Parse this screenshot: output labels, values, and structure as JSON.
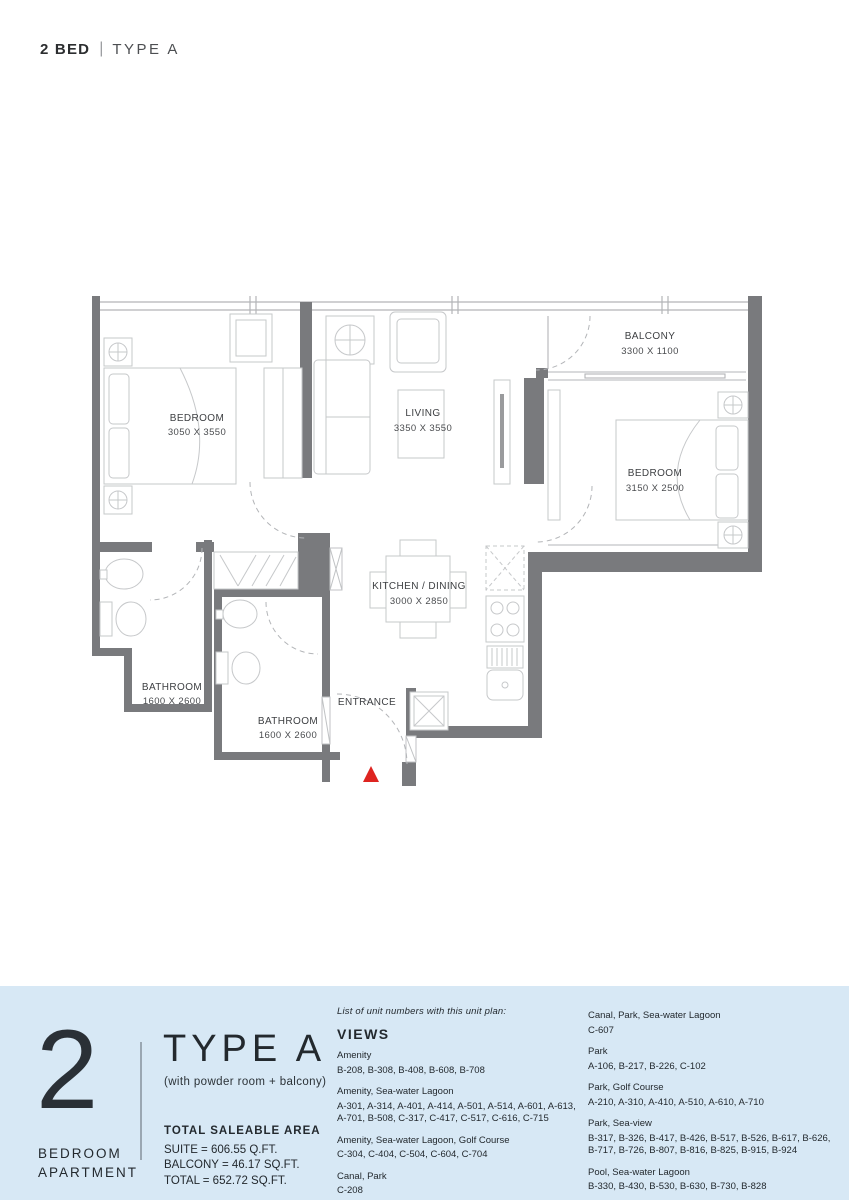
{
  "header": {
    "bed": "2 BED",
    "sep": "|",
    "type": "TYPE A"
  },
  "plan": {
    "rooms": [
      {
        "name": "BEDROOM",
        "dims": "3050 X 3550"
      },
      {
        "name": "LIVING",
        "dims": "3350 X 3550"
      },
      {
        "name": "BALCONY",
        "dims": "3300 X 1100"
      },
      {
        "name": "BEDROOM",
        "dims": "3150 X 2500"
      },
      {
        "name": "KITCHEN / DINING",
        "dims": "3000 X 2850"
      },
      {
        "name": "BATHROOM",
        "dims": "1600 X 2600"
      },
      {
        "name": "BATHROOM",
        "dims": "1600 X 2600"
      },
      {
        "name": "ENTRANCE",
        "dims": ""
      }
    ],
    "colors": {
      "wall": "#797a7d",
      "line": "#c6c8ca",
      "window": "#b3b5b8",
      "marker": "#de2420"
    }
  },
  "footer": {
    "unit_number": "2",
    "unit_label_line1": "BEDROOM",
    "unit_label_line2": "APARTMENT",
    "type_title": "TYPE A",
    "type_subtitle": "(with powder room + balcony)",
    "area": {
      "heading": "TOTAL SALEABLE AREA",
      "suite": "SUITE = 606.55 Q.FT.",
      "balcony": "BALCONY = 46.17 SQ.FT.",
      "total": "TOTAL = 652.72 SQ.FT."
    },
    "views": {
      "intro": "List of unit numbers with this unit plan:",
      "heading": "VIEWS",
      "col1": [
        {
          "label": "Amenity",
          "units": "B-208, B-308, B-408, B-608, B-708"
        },
        {
          "label": "Amenity, Sea-water Lagoon",
          "units": "A-301, A-314, A-401, A-414, A-501, A-514, A-601, A-613, A-701, B-508, C-317, C-417, C-517, C-616, C-715"
        },
        {
          "label": "Amenity, Sea-water Lagoon, Golf Course",
          "units": "C-304, C-404, C-504, C-604, C-704"
        },
        {
          "label": "Canal, Park",
          "units": "C-208"
        },
        {
          "label": "Canal, Park, Sea-view",
          "units": "C-308, C-408, C-508"
        }
      ],
      "col2": [
        {
          "label": "Canal, Park, Sea-water Lagoon",
          "units": "C-607"
        },
        {
          "label": "Park",
          "units": "A-106, B-217, B-226, C-102"
        },
        {
          "label": "Park, Golf Course",
          "units": "A-210, A-310, A-410, A-510, A-610, A-710"
        },
        {
          "label": "Park, Sea-view",
          "units": "B-317, B-326, B-417, B-426, B-517, B-526, B-617, B-626, B-717, B-726, B-807, B-816, B-825, B-915, B-924"
        },
        {
          "label": "Pool, Sea-water Lagoon",
          "units": "B-330, B-430, B-530, B-630, B-730, B-828"
        },
        {
          "label": "Pool, Sea-water Lagoon, Golf Course",
          "units": "B-304, B-404, B-504, B-604, B-704, B-804, B-904"
        }
      ]
    }
  }
}
